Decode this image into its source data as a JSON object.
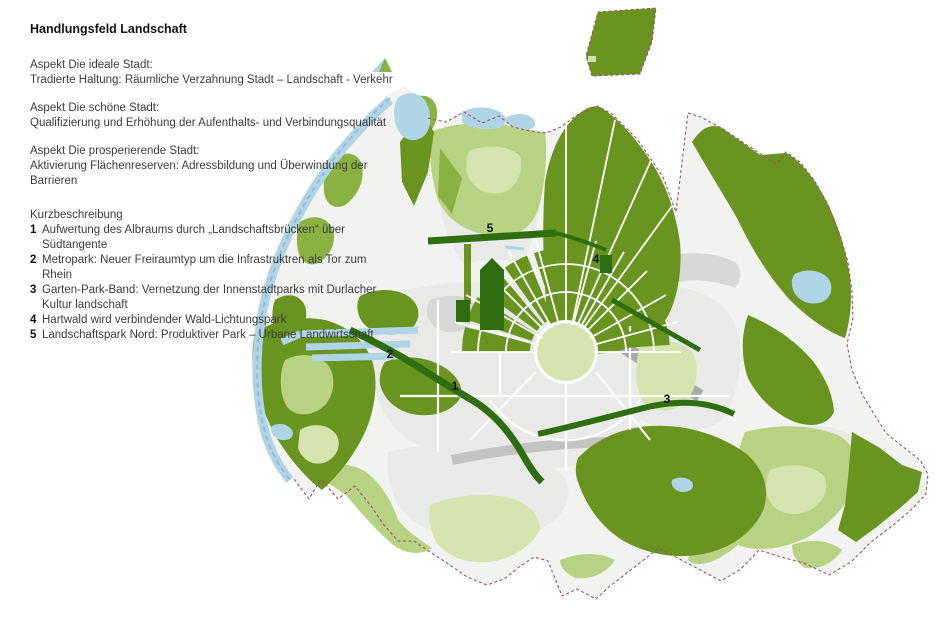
{
  "panel": {
    "title": "Handlungsfeld Landschaft",
    "aspects": [
      {
        "heading": "Aspekt Die ideale Stadt:",
        "description": "Tradierte Haltung: Räumliche Verzahnung Stadt – Landschaft - Verkehr"
      },
      {
        "heading": "Aspekt Die schöne Stadt:",
        "description": "Qualifizierung und Erhöhung der Aufenthalts- und Verbindungsqualität"
      },
      {
        "heading": "Aspekt Die prosperierende Stadt:",
        "description": "Aktivierung Flächenreserven: Adressbildung und Überwindung der Barrieren"
      }
    ],
    "kurzbeschreibung": {
      "heading": "Kurzbeschreibung",
      "items": [
        {
          "num": "1",
          "text": "Aufwertung des Albraums durch „Landschaftsbrücken“ über Südtangente"
        },
        {
          "num": "2",
          "text": "Metropark: Neuer Freiraumtyp um die Infrastruktren als Tor zum Rhein"
        },
        {
          "num": "3",
          "text": "Garten-Park-Band: Vernetzung der Innenstadtparks mit Durlacher Kultur landschaft"
        },
        {
          "num": "4",
          "text": "Hartwald wird verbindender Wald-Lichtungspark"
        },
        {
          "num": "5",
          "text": "Landschaftspark Nord: Produktiver Park – Urbane Landwirtschaft"
        }
      ]
    }
  },
  "map": {
    "markers": [
      {
        "label": "1"
      },
      {
        "label": "2"
      },
      {
        "label": "3"
      },
      {
        "label": "4"
      },
      {
        "label": "5"
      }
    ],
    "colors": {
      "base": "#f2f2f0",
      "urban": "#e9e9e7",
      "urban2": "#d7d7d5",
      "rail": "#a9a9a7",
      "rail2": "#c3c3c1",
      "forest": "#68941f",
      "forest-dark": "#2e6e10",
      "green-mid": "#8ab141",
      "green-light": "#b7d282",
      "green-pale": "#d5e4ae",
      "water": "#aed4e5",
      "boundary-blue": "#8fb3da",
      "boundary-red": "#a34e6e",
      "marker": "#111111"
    }
  }
}
